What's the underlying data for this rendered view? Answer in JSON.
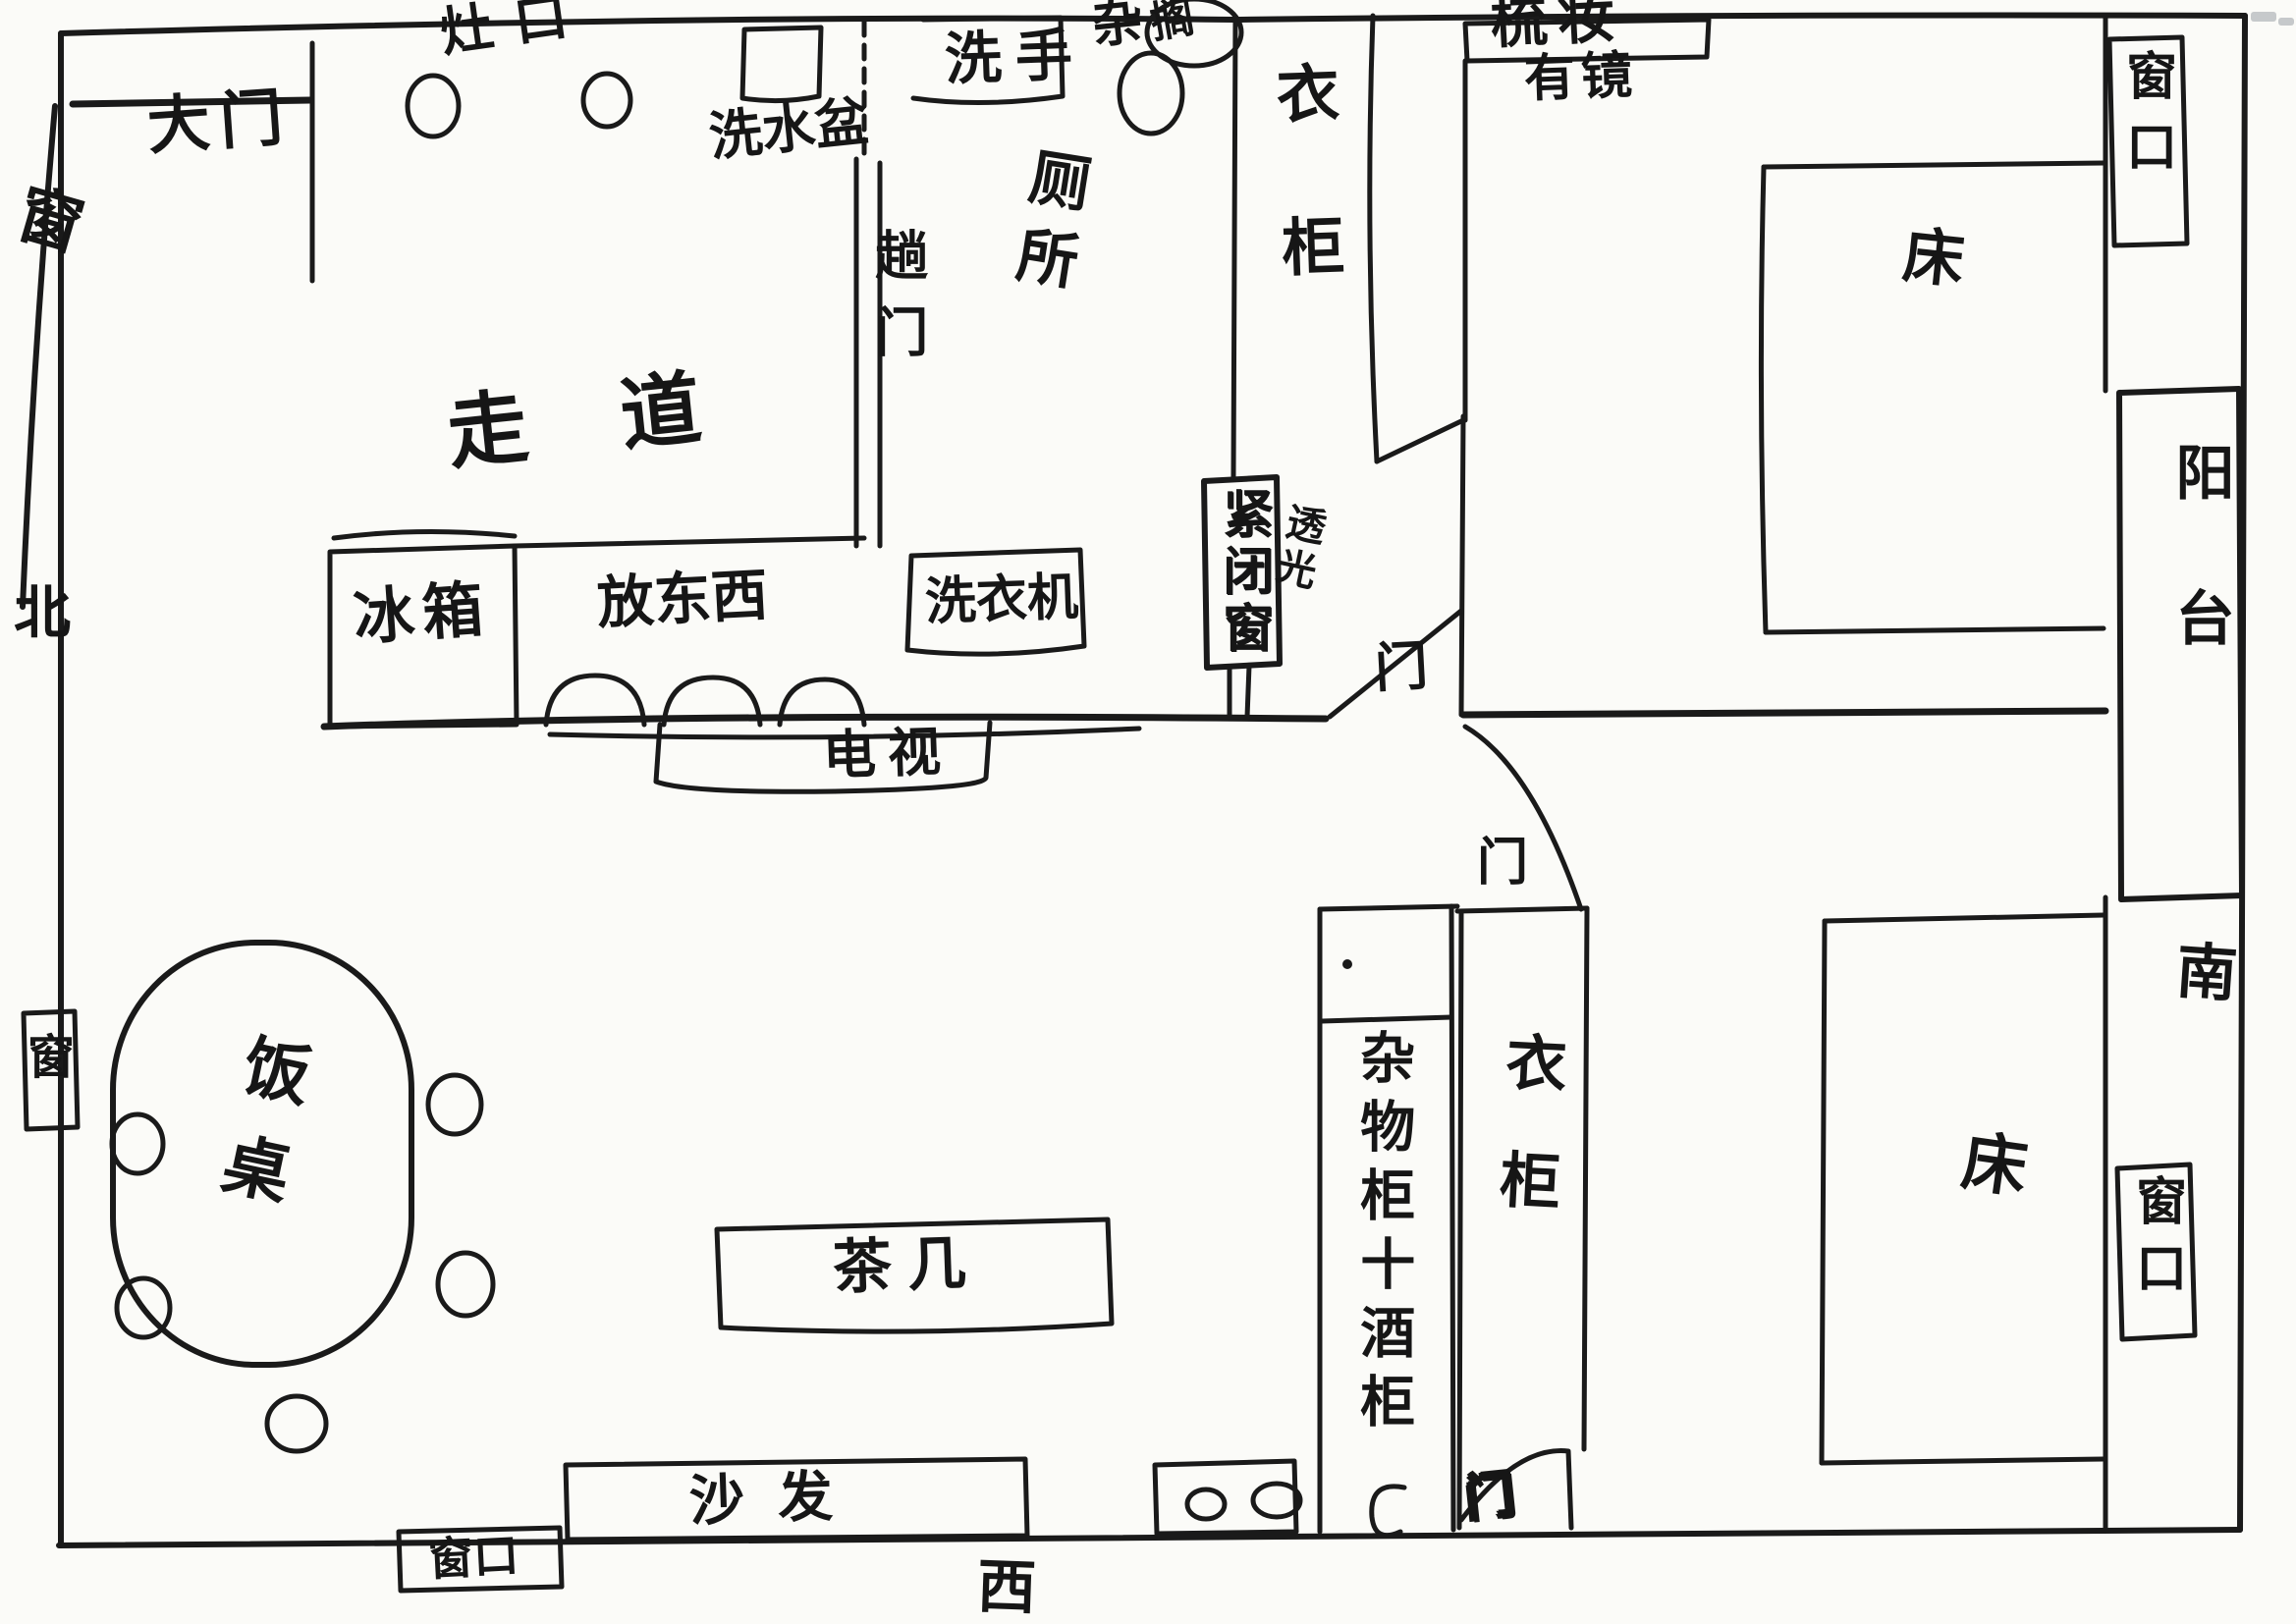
{
  "colors": {
    "ink": "#1a1a1a",
    "paper": "#fbfbf8",
    "artifact": "#9aa0a6"
  },
  "compass": {
    "north": "北",
    "west": "西",
    "south": "南"
  },
  "entry": {
    "main_door": "大门"
  },
  "windows": {
    "left_upper": "窗",
    "left_lower": "窗",
    "top_right_vertical": "窗口",
    "right_lower_vertical": "窗口",
    "bottom_left": "窗口",
    "sealed_window": "紧闭窗",
    "light_note": "透光"
  },
  "kitchen": {
    "stove": "灶口",
    "wash_basin": "洗水盆",
    "fridge": "冰箱",
    "counter_storage": "放东西",
    "sliding_door": "趟门"
  },
  "corridor": {
    "label": "走道"
  },
  "bathroom": {
    "hand_wash": "洗手",
    "toilet": "厕所",
    "misc_prefix": "杂",
    "misc_circled": "搁",
    "washing_machine": "洗衣机"
  },
  "bedroom_top": {
    "wardrobe": "衣柜",
    "dresser": "梳妆",
    "dresser_note": "有镜",
    "bed": "床",
    "door": "门"
  },
  "balcony": {
    "label": "阳台"
  },
  "living_room": {
    "tv": "电视",
    "dining_table": "饭桌",
    "tea_table": "茶几",
    "sofa": "沙发"
  },
  "bedroom_bottom": {
    "cabinet": "杂物柜十酒柜",
    "wardrobe": "衣柜",
    "bed": "床",
    "door": "门",
    "closet_door": "门"
  }
}
